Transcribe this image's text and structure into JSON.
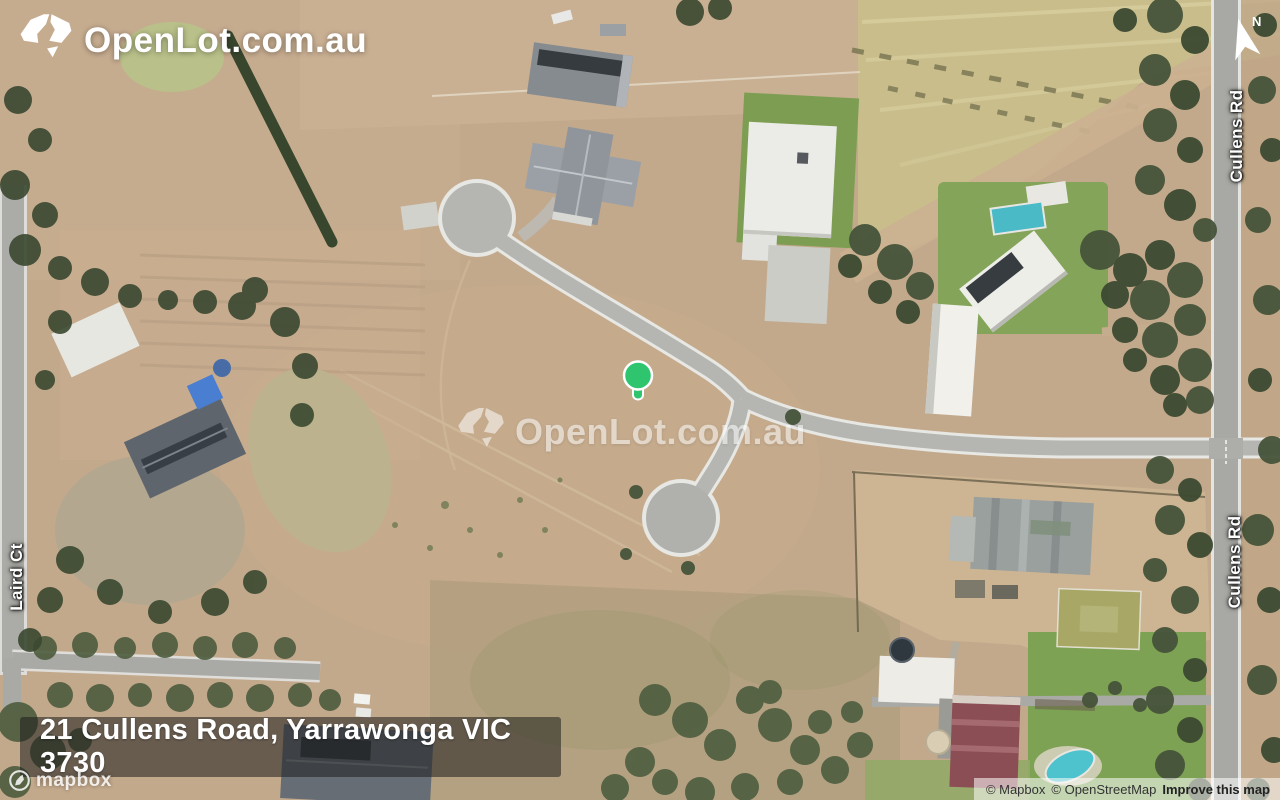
{
  "brand": {
    "logo_text": "OpenLot.com.au"
  },
  "watermark": {
    "text": "OpenLot.com.au"
  },
  "map": {
    "north_indicator": "N",
    "marker_color": "#2FC56F",
    "road_labels": {
      "cullens_rd": "Cullens Rd",
      "laird_ct": "Laird Ct"
    }
  },
  "address_bar": {
    "text": "21 Cullens Road, Yarrawonga VIC 3730"
  },
  "attribution": {
    "mapbox_logo": "mapbox",
    "mapbox": "© Mapbox",
    "openstreetmap": "© OpenStreetMap",
    "improve": "Improve this map"
  }
}
